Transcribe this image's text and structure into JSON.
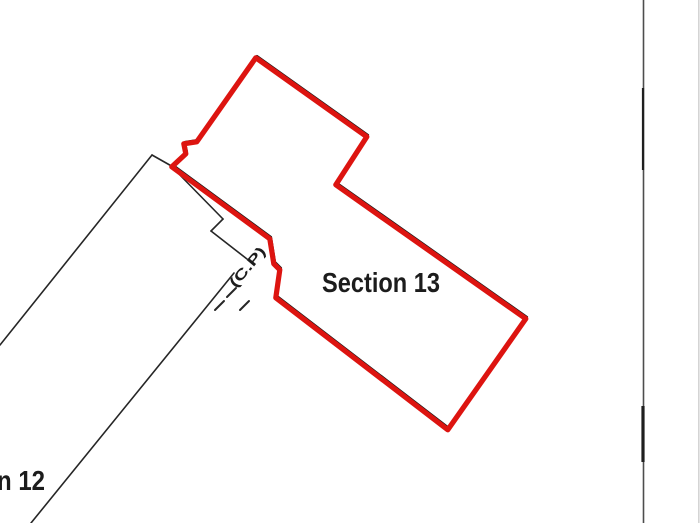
{
  "canvas": {
    "width": 700,
    "height": 523,
    "background": "#ffffff"
  },
  "colors": {
    "highlight_red": "#dd1410",
    "boundary_black": "#1a1a1a",
    "parcel_line_black": "#262626",
    "survey_line_gray": "#4d4d4d",
    "survey_line_dark_segment": "#1f1f1f",
    "edge_fade_gray": "#d4d4d4",
    "label_black": "#1c1c1c"
  },
  "labels": {
    "section13": {
      "text": "Section 13",
      "x": 322,
      "y": 292,
      "font_size": 28,
      "text_length": 118,
      "rotation": 0
    },
    "section12_partial": {
      "text": "n 12",
      "x": -3,
      "y": 490,
      "font_size": 28,
      "text_length": 48,
      "rotation": 0
    },
    "cp": {
      "text": "(C.P)",
      "x": 251,
      "y": 270,
      "font_size": 14,
      "text_length": 48,
      "rotation": -50
    }
  },
  "geometry": {
    "section13_red_polygon": {
      "closed": true,
      "stroke_width_red": 5.2,
      "stroke_width_black": 2.2,
      "red_offset": {
        "dx": -1.2,
        "dy": 1.8
      },
      "points": [
        [
          257,
          56
        ],
        [
          368,
          135
        ],
        [
          337,
          183
        ],
        [
          527,
          317
        ],
        [
          449,
          428
        ],
        [
          277,
          296
        ],
        [
          281,
          268
        ],
        [
          275,
          262
        ],
        [
          271,
          237
        ],
        [
          173,
          165
        ],
        [
          187,
          152
        ],
        [
          185,
          142
        ],
        [
          198,
          140
        ]
      ]
    },
    "section12_black_lines": [
      {
        "name": "strip-upper-left-edge",
        "points": [
          [
            0,
            345
          ],
          [
            152,
            155
          ]
        ]
      },
      {
        "name": "strip-end-edge",
        "points": [
          [
            152,
            155
          ],
          [
            175,
            168
          ]
        ]
      },
      {
        "name": "strip-lower-right-edge",
        "points": [
          [
            175,
            170
          ],
          [
            223,
            219
          ]
        ]
      },
      {
        "name": "notch-step-edge",
        "points": [
          [
            223,
            219
          ],
          [
            211,
            231
          ]
        ]
      },
      {
        "name": "lane-upper-edge",
        "points": [
          [
            211,
            231
          ],
          [
            247,
            259
          ]
        ]
      },
      {
        "name": "lane-long-edge",
        "points": [
          [
            31,
            523
          ],
          [
            234,
            273
          ]
        ]
      }
    ],
    "lane_dashes": [
      {
        "points": [
          [
            215,
            310
          ],
          [
            224,
            301
          ]
        ]
      },
      {
        "points": [
          [
            227,
            297
          ],
          [
            236,
            288
          ]
        ]
      },
      {
        "points": [
          [
            240,
            310
          ],
          [
            249,
            301
          ]
        ]
      }
    ],
    "survey_line": {
      "x": 643.5,
      "y1": 0,
      "y2": 523,
      "width": 1.6,
      "dark_segments": [
        {
          "y1": 88,
          "y2": 170,
          "width": 2.2
        },
        {
          "y1": 406,
          "y2": 462,
          "width": 3.2
        }
      ]
    },
    "right_edge_line": {
      "x": 698.8,
      "y1": 0,
      "y2": 523,
      "width": 1.6
    }
  }
}
